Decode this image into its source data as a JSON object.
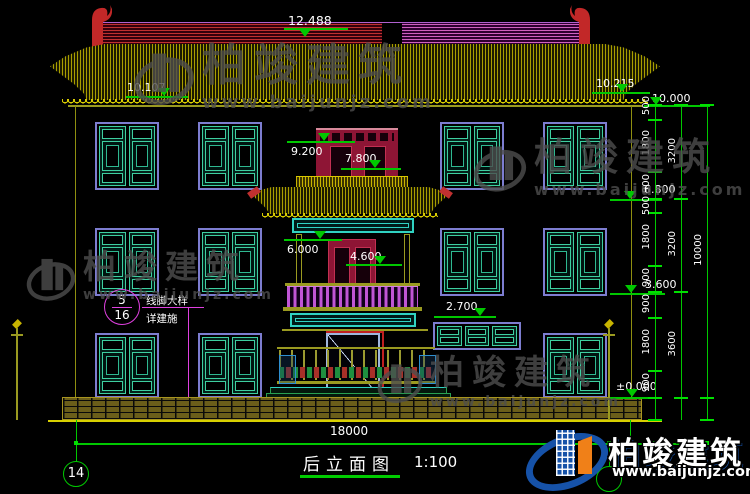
{
  "title_block": {
    "title": "后立面图",
    "scale": "1:100"
  },
  "grid": {
    "left_bubble": "14",
    "right_bubble": ""
  },
  "annotations": {
    "elev_ridge": "12.488",
    "elev_left_eave": "10.107",
    "elev_right_eave": "10.215",
    "elev_right_top": "10.000",
    "elev_pavilion_top": "9.200",
    "elev_pavilion_eave": "7.800",
    "elev_level3": "6.800",
    "elev_pavilion2_top": "6.000",
    "elev_pavilion2_door": "4.600",
    "elev_level2": "3.600",
    "elev_high_window": "2.700",
    "elev_ground": "±0.000"
  },
  "dimensions": {
    "total_width": "18000",
    "chain_inner": [
      "500",
      "1800",
      "900",
      "500",
      "1800",
      "900",
      "900",
      "1800",
      "900"
    ],
    "chain_mid": [
      "3200",
      "3200",
      "3600"
    ],
    "chain_overall": "10000"
  },
  "callout": {
    "numerator": "5",
    "denominator": "16",
    "line1": "线脚大样",
    "line2": "详建施"
  },
  "watermark": {
    "name": "柏竣建筑",
    "url": "www.baijunjz.com"
  },
  "logo": {
    "name": "柏竣建筑",
    "url": "www.baijunjz.com"
  },
  "colors": {
    "dimension_green": "#00c800",
    "roof_yellow": "#a89e00",
    "ridge_red": "#c03030",
    "ridge_magenta": "#d060c0",
    "window_frame_purple": "#7d7dd0",
    "window_teal": "#3ecfa0",
    "cyan_beam": "#30d2c2",
    "pavilion_maroon": "#8e1535",
    "baluster_magenta": "#c055d5",
    "callout_magenta": "#e040e0",
    "logo_blue": "#1652a8",
    "logo_orange": "#f08018"
  }
}
